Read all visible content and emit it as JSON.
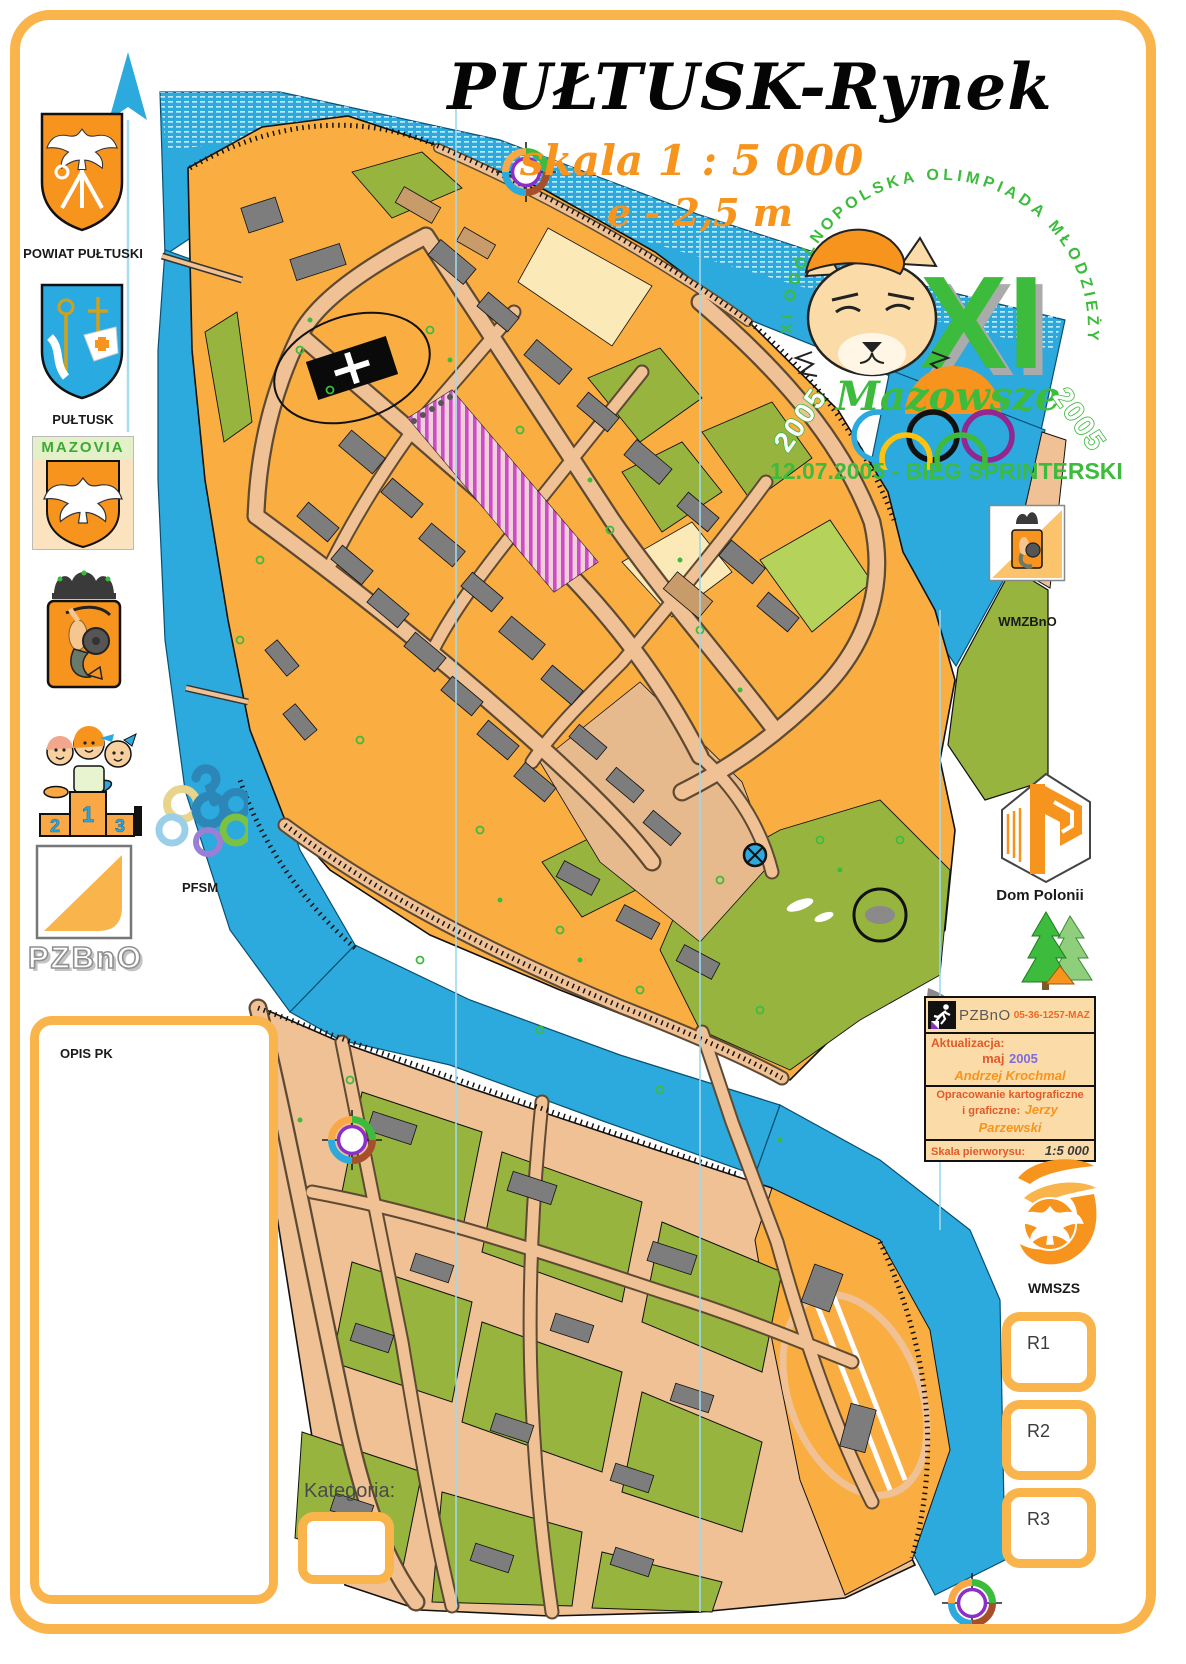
{
  "header": {
    "title": "PUŁTUSK-Rynek",
    "scale_line": "skala 1 : 5 000",
    "equidistance_line": "e - 2,5 m"
  },
  "event_logo": {
    "arc_text": "XI OGÓLNOPOLSKA OLIMPIADA MŁODZIEŻY W SPORTACH LETNICH",
    "numeral": "XI",
    "region_script": "Mazowsze",
    "year_left": "2005",
    "year_right": "2005",
    "date_line": "12.07.2005 - BIEG SPRINTERSKI"
  },
  "left_column": {
    "powiat_label": "POWIAT PUŁTUSKI",
    "pultusk_label": "PUŁTUSK",
    "mazovia_banner": "MAZOVIA",
    "podium_numbers": {
      "first": "1",
      "second": "2",
      "third": "3"
    },
    "pfsm_label": "PFSM",
    "pzbno_letters": "PZBnO",
    "opis_pk_label": "OPIS PK"
  },
  "right_column": {
    "wmzbno_label": "WMZBnO",
    "dom_polonii_label": "Dom Polonii",
    "wmszs_label": "WMSZS",
    "relay_boxes": [
      "R1",
      "R2",
      "R3"
    ]
  },
  "info_box": {
    "org": "PZBnO",
    "map_code": "05-36-1257-MAZ",
    "update_label": "Aktualizacja:",
    "update_month": "maj",
    "update_year": "2005",
    "update_author": "Andrzej Krochmal",
    "cartography_line1": "Opracowanie kartograficzne",
    "cartography_line2": "i graficzne:",
    "cartography_author": "Jerzy Parzewski",
    "scale_label": "Skala pierworysu:",
    "scale_value": "1:5 000"
  },
  "footer": {
    "kategoria_label": "Kategoria:"
  },
  "map": {
    "colors": {
      "water": "#2CA9DD",
      "open_land": "#FAAE42",
      "street": "#EFC195",
      "building": "#7D7D7D",
      "vegetation": "#97B43F",
      "pale_yellow": "#FBE9B7",
      "out_of_bounds_stripe": "#CC3ECC",
      "frame_orange": "#F9B54C",
      "event_green": "#3DBB3D",
      "heading_orange": "#F7941D"
    }
  }
}
